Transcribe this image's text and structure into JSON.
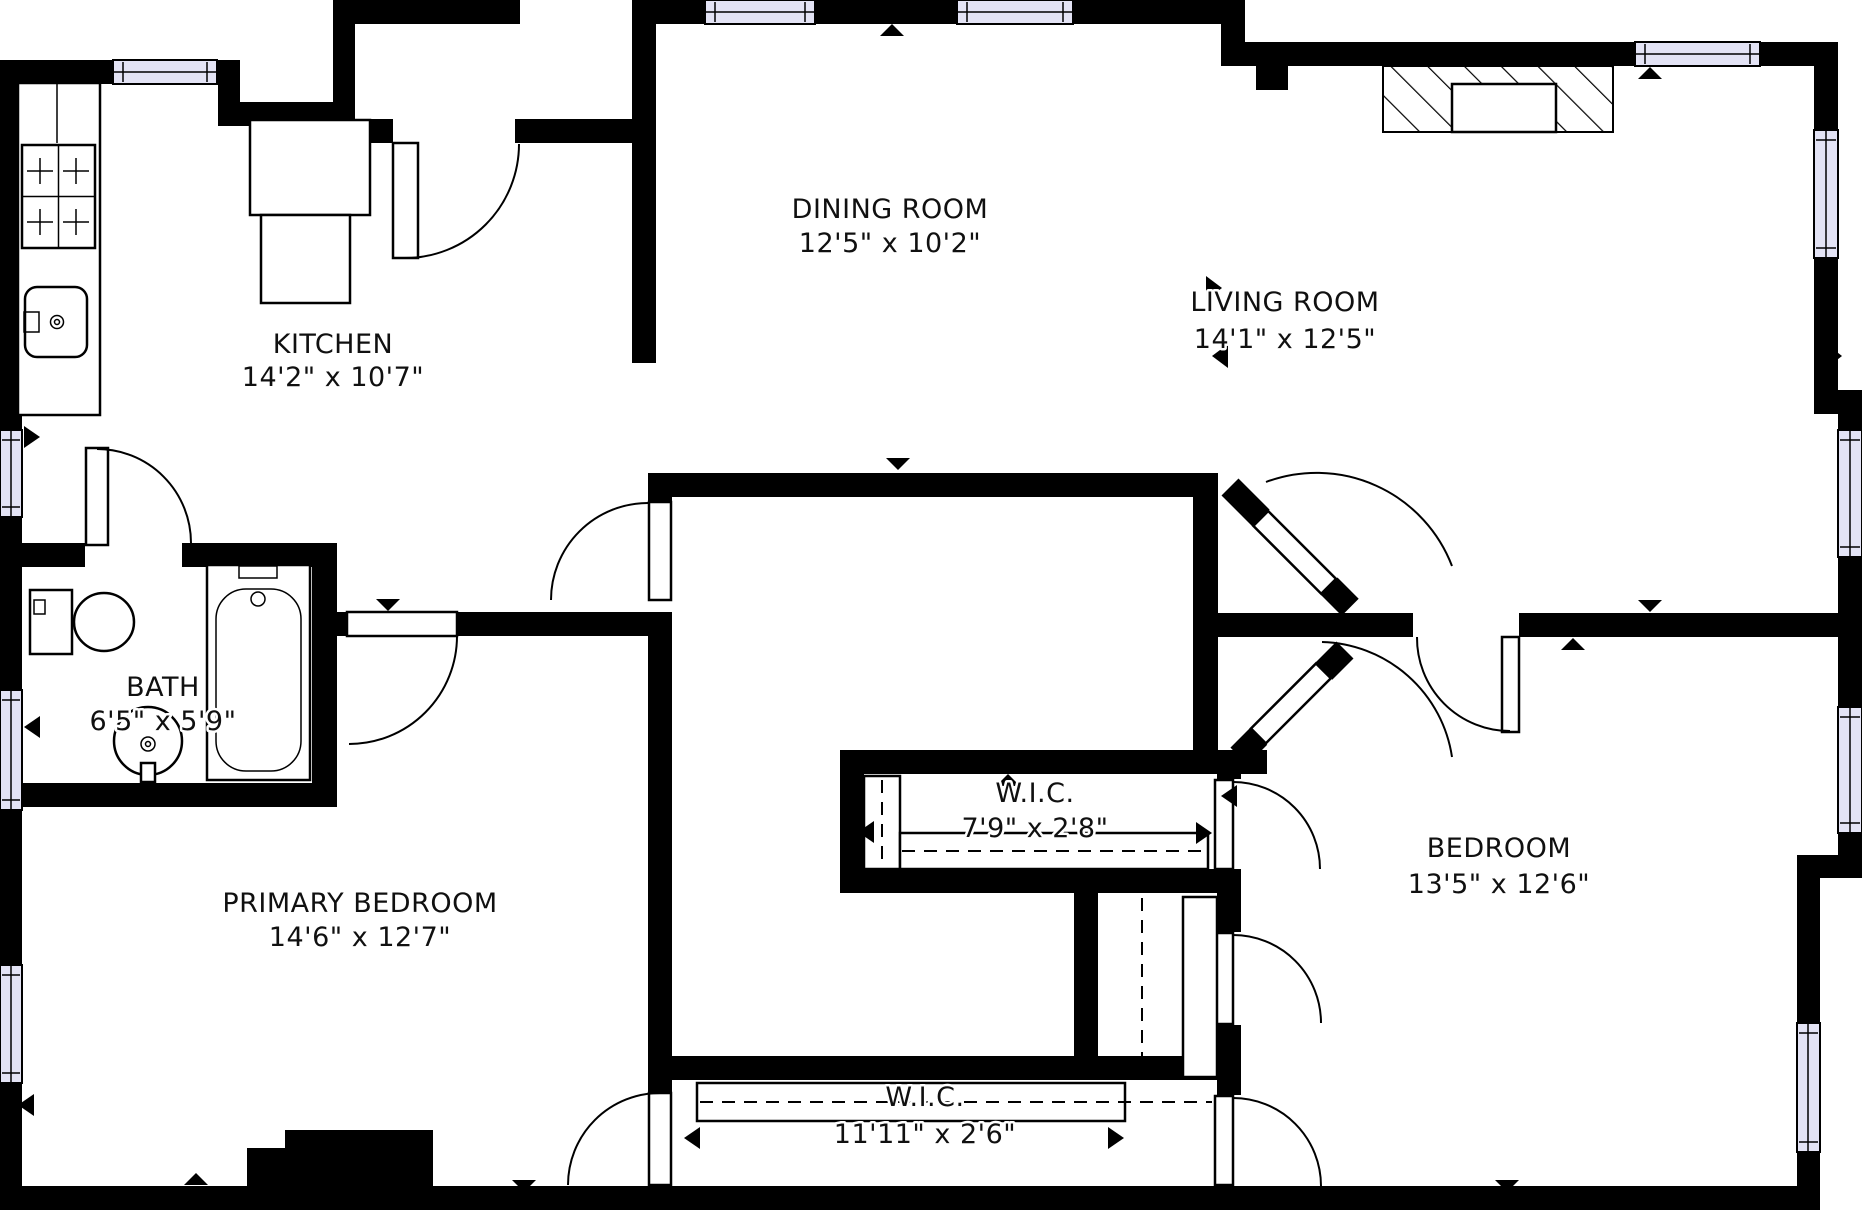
{
  "colors": {
    "wall": "#000000",
    "background": "#ffffff",
    "window_fill": "#e3e3f5",
    "line": "#000000"
  },
  "rooms": [
    {
      "name": "DINING ROOM",
      "dims": "12'5\" x 10'2\""
    },
    {
      "name": "LIVING ROOM",
      "dims": "14'1\" x 12'5\""
    },
    {
      "name": "KITCHEN",
      "dims": "14'2\" x 10'7\""
    },
    {
      "name": "BATH",
      "dims": "6'5\" x 5'9\""
    },
    {
      "name": "PRIMARY BEDROOM",
      "dims": "14'6\" x 12'7\""
    },
    {
      "name": "BEDROOM",
      "dims": "13'5\" x 12'6\""
    },
    {
      "name": "W.I.C.",
      "dims": "7'9\" x 2'8\""
    },
    {
      "name": "W.I.C.",
      "dims": "11'11\" x 2'6\""
    }
  ],
  "fixtures": [
    "stove",
    "kitchen-counter",
    "kitchen-sink",
    "kitchen-island",
    "toilet",
    "pedestal-sink",
    "bathtub",
    "fireplace",
    "closet-rod",
    "closet-shelf"
  ],
  "legend": {
    "door_symbol": "quarter-arc-swing",
    "window_symbol": "lavender-band",
    "wall_symbol": "solid-black"
  }
}
